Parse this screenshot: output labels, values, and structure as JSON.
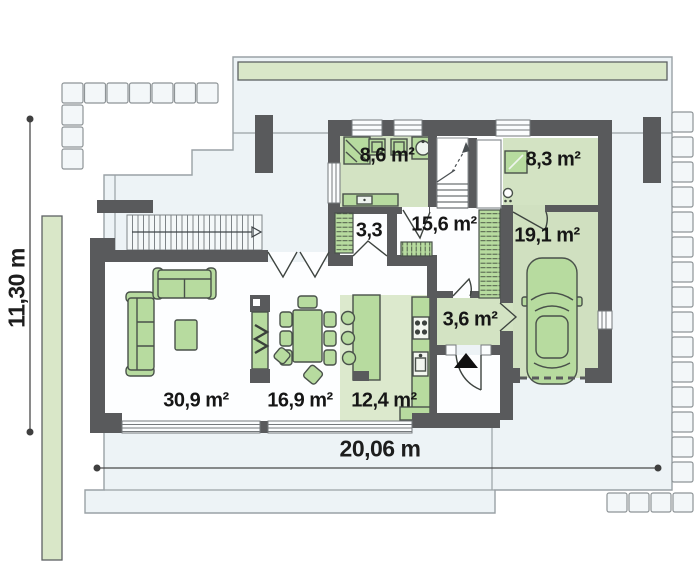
{
  "plan": {
    "type": "floor-plan",
    "rooms": {
      "bathroom": {
        "label": "8,6 m²"
      },
      "wc": {
        "label": "3,3"
      },
      "hallway": {
        "label": "15,6 m²"
      },
      "utility": {
        "label": "8,3 m²"
      },
      "garage": {
        "label": "19,1 m²"
      },
      "vestibule": {
        "label": "3,6 m²"
      },
      "living": {
        "label": "30,9 m²"
      },
      "dining": {
        "label": "16,9 m²"
      },
      "kitchen": {
        "label": "12,4 m²"
      }
    },
    "dimensions": {
      "overall_width": "20,06 m",
      "overall_height": "11,30 m"
    },
    "colors": {
      "wall": "#595a5c",
      "room_floor_green": "#d3e3c3",
      "furniture_green": "#b7db9f",
      "plot_fill": "#edf3f6",
      "greenery_strip": "#d9e7c8",
      "label_text": "#161616"
    }
  }
}
